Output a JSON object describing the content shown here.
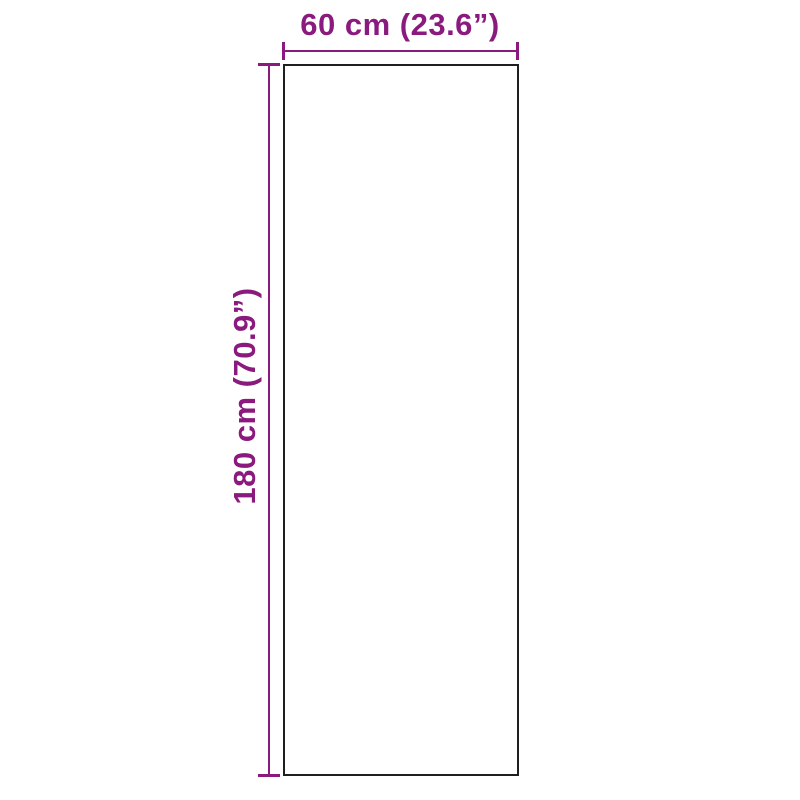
{
  "diagram": {
    "type": "product-dimension-diagram",
    "shape": "rectangle",
    "width": {
      "label": "60 cm (23.6”)",
      "value_cm": 60,
      "value_in": 23.6
    },
    "height": {
      "label": "180 cm (70.9”)",
      "value_cm": 180,
      "value_in": 70.9
    },
    "colors": {
      "dimension": "#8B1A7E",
      "outline": "#1f1f1f",
      "background": "#ffffff"
    }
  }
}
